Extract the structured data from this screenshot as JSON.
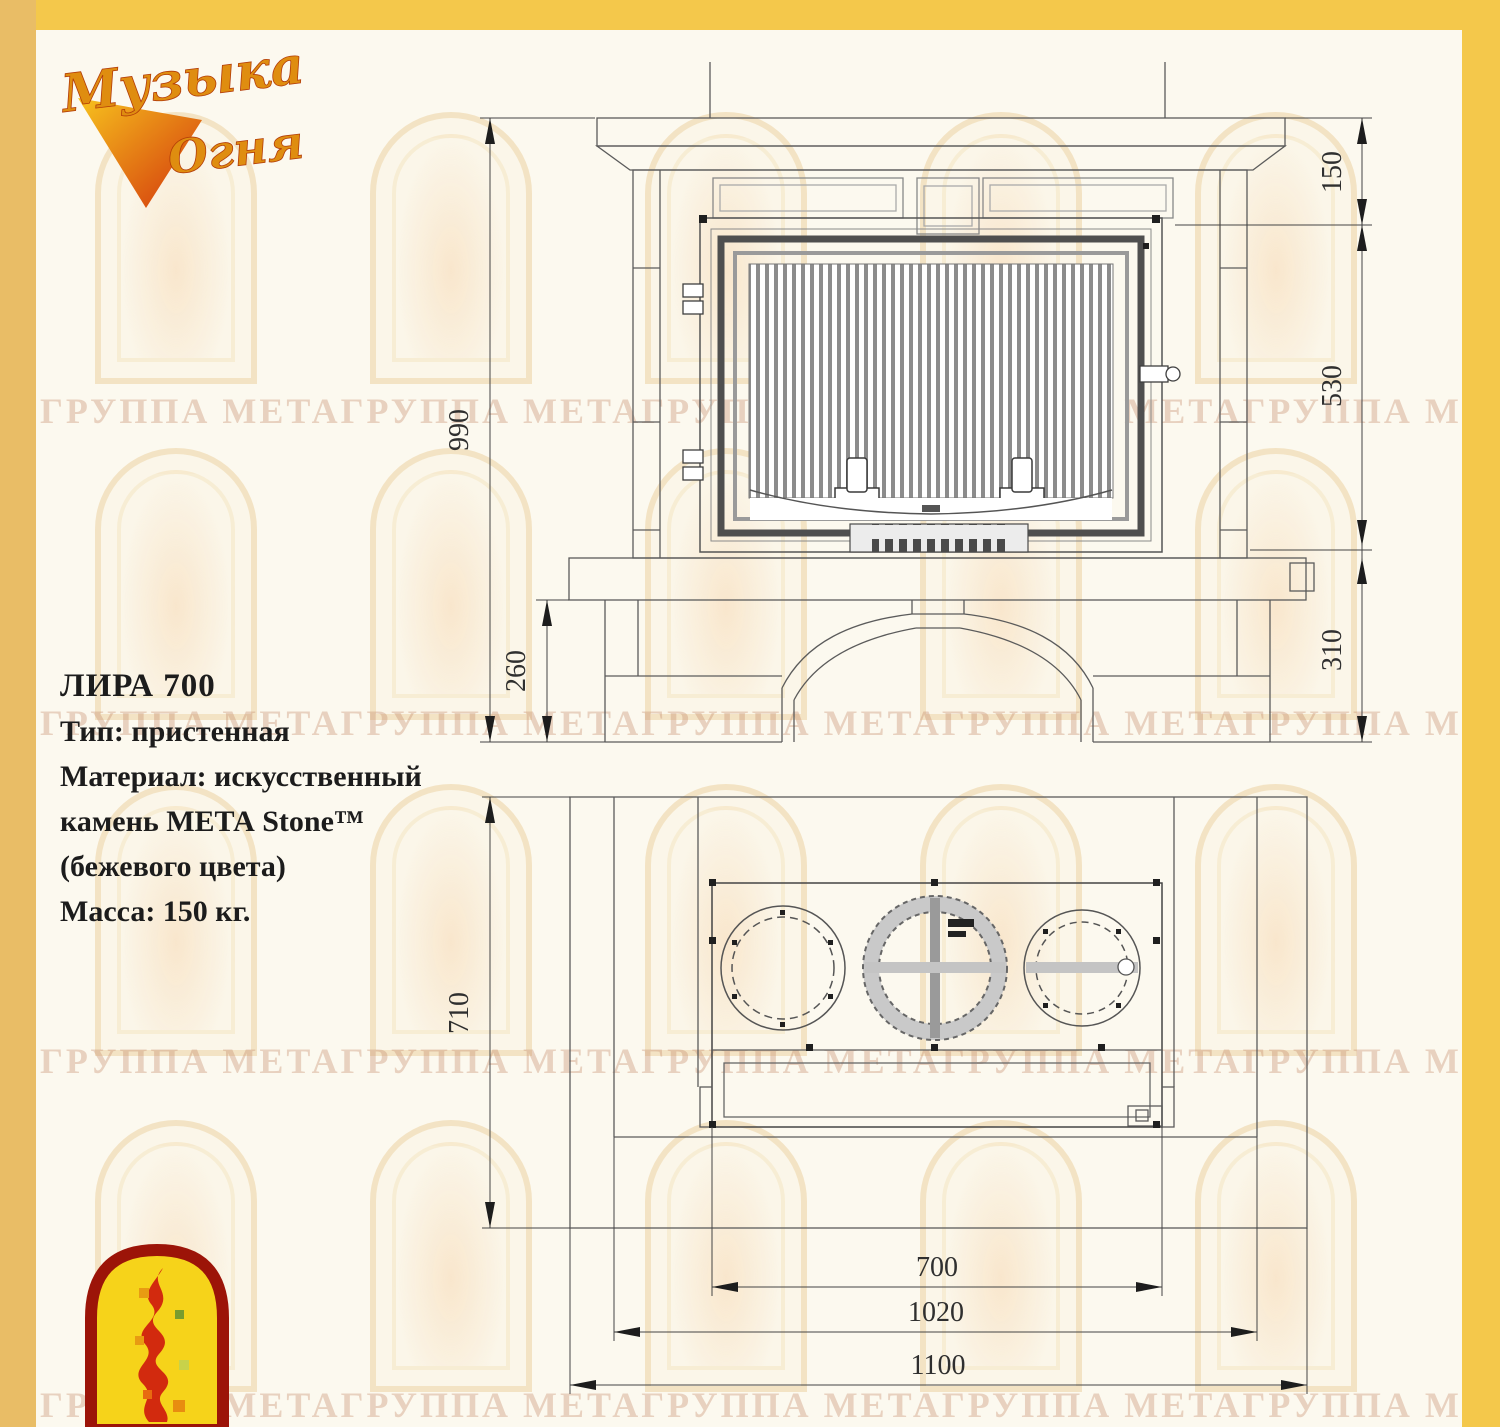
{
  "watermark": {
    "text": "ГРУППА МЕТАГРУППА МЕТАГРУППА МЕТАГРУППА МЕТАГРУППА МЕТА"
  },
  "brand": {
    "logo_word1": "Музыка",
    "logo_word2": "Огня"
  },
  "specs": {
    "title": "ЛИРА 700",
    "lines": [
      "Тип: пристенная",
      "Материал: искусственный",
      "камень МЕТА Stone™",
      "(бежевого цвета)",
      "Масса: 150 кг."
    ]
  },
  "front_view": {
    "dims": {
      "total_height": "990",
      "base_height_left": "260",
      "mantel_height": "150",
      "firebox_height": "530",
      "base_height_right": "310"
    }
  },
  "plan_view": {
    "dims": {
      "depth": "710",
      "firebox_width": "700",
      "inner_width": "1020",
      "total_width": "1100"
    }
  },
  "colors": {
    "frame_gold": "#f4c84b",
    "line": "#5b5b5b",
    "arrow": "#1d1d1d",
    "logo_orange": "#df8d10",
    "logo_red": "#d22a0e",
    "logo_yellow": "#f6d31a"
  }
}
